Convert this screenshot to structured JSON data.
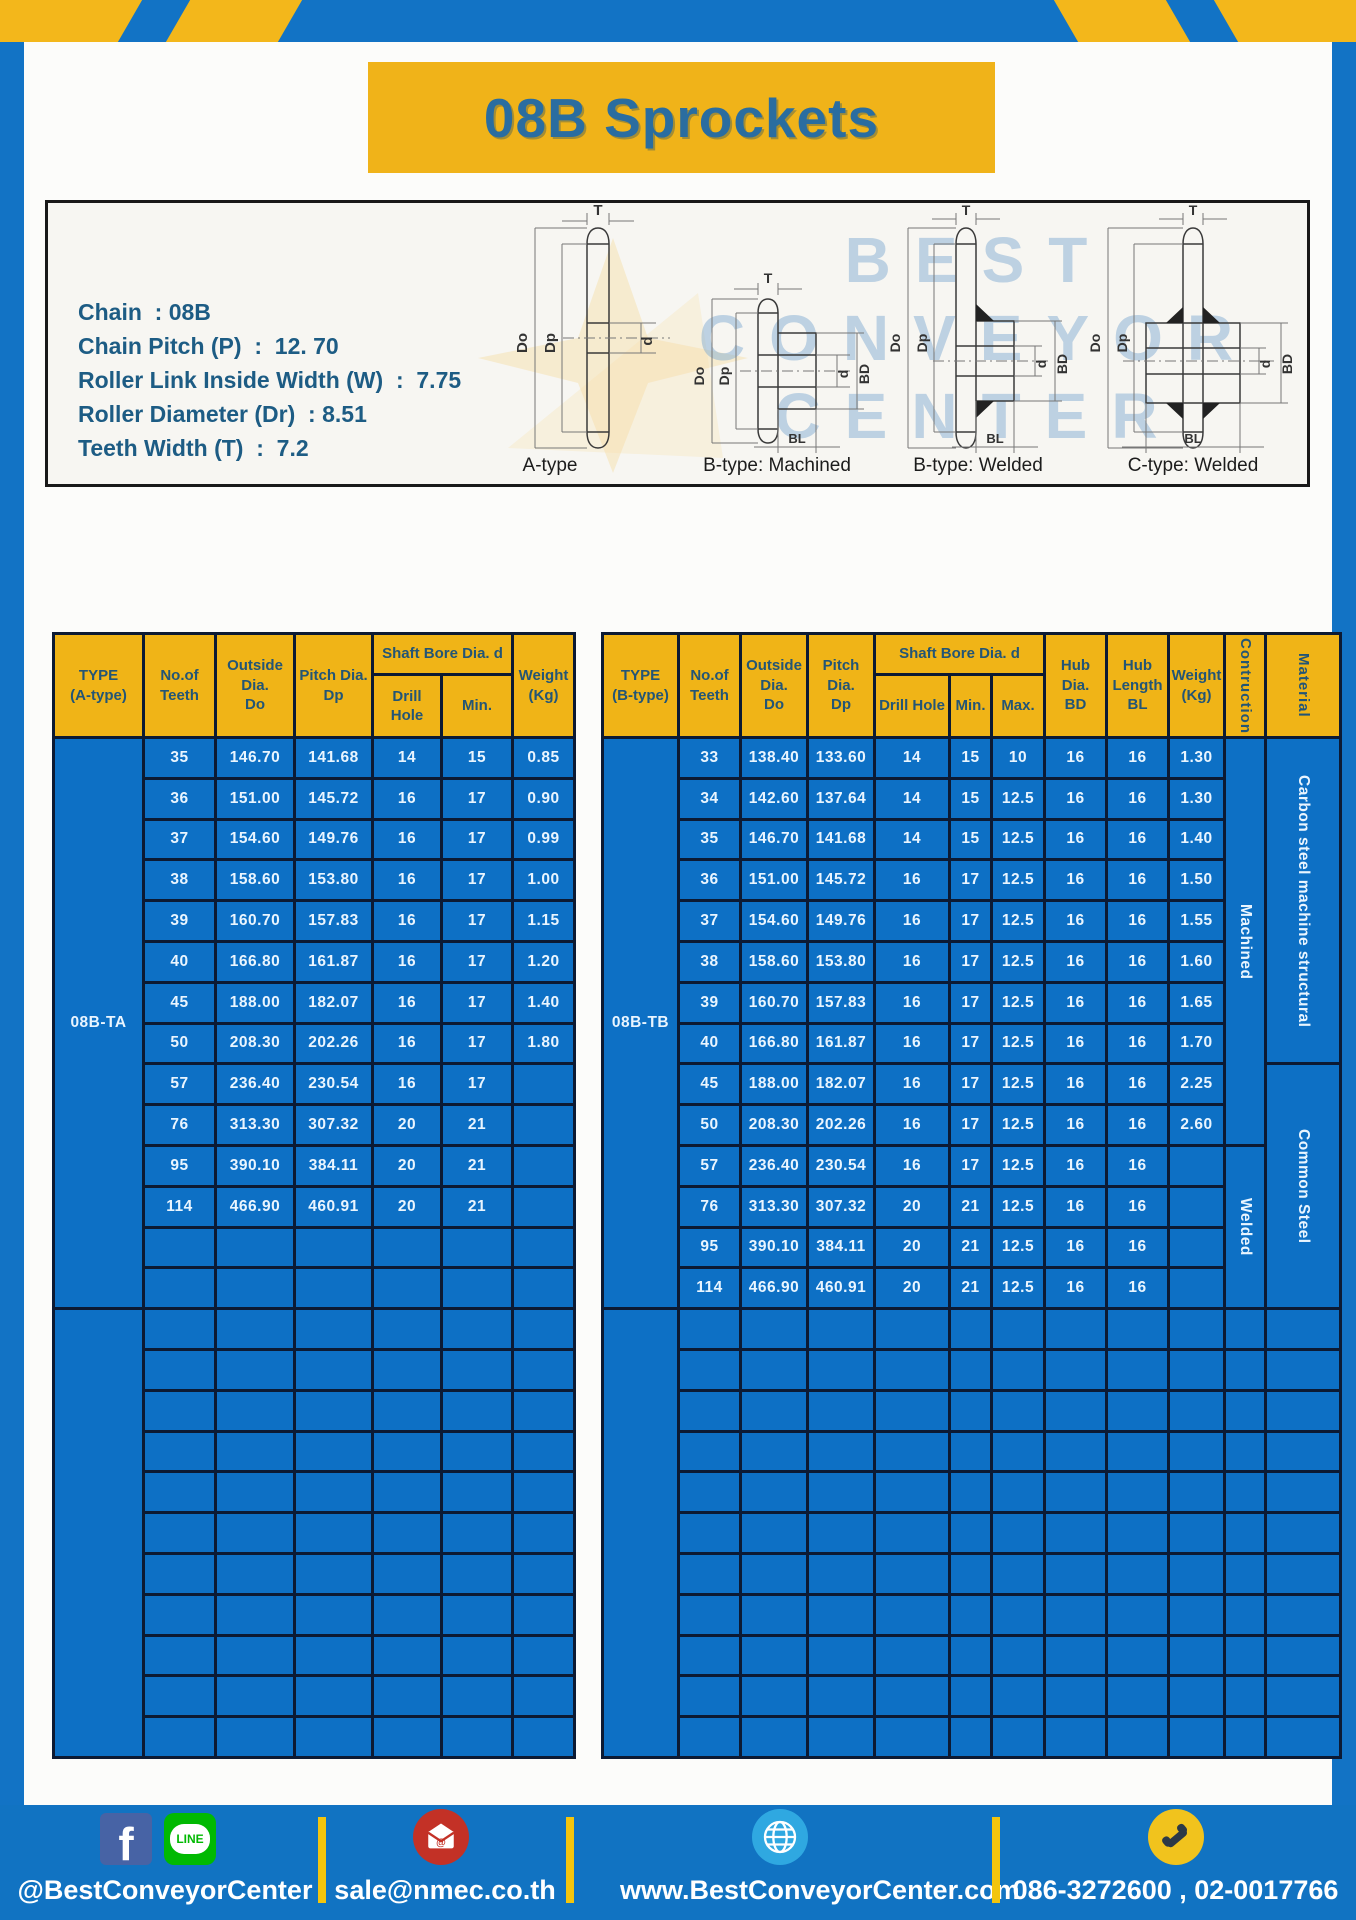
{
  "header": {
    "title": "08B Sprockets"
  },
  "specs": {
    "lines": [
      "Chain  : 08B",
      "Chain Pitch (P)  :  12. 70",
      "Roller Link Inside Width (W)  :  7.75",
      "Roller Diameter (Dr)  : 8.51",
      "Teeth Width (T)  :  7.2"
    ]
  },
  "diagram": {
    "captions": [
      "A-type",
      "B-type: Machined",
      "B-type: Welded",
      "C-type: Welded"
    ],
    "labels": {
      "t": "T",
      "outer": "Do",
      "pitch": "Dp",
      "bore": "d",
      "hub_dia": "BD",
      "hub_len": "BL"
    },
    "watermark": [
      "BEST",
      "CONVEYOR",
      "CENTER"
    ]
  },
  "tables": {
    "left": {
      "header": {
        "type": "TYPE\n(A-type)",
        "teeth": "No.of\nTeeth",
        "outside": "Outside\nDia.\nDo",
        "pitch": "Pitch Dia.\nDp",
        "shaft_bore": "Shaft Bore Dia. d",
        "drill": "Drill Hole",
        "min": "Min.",
        "weight": "Weight\n(Kg)"
      },
      "col_widths": [
        90,
        72,
        79,
        78,
        69,
        71,
        62
      ],
      "data_cols": 6,
      "total_rows": 25,
      "type_groups": [
        {
          "label": "08B-TA",
          "span": 14
        },
        {
          "label": "",
          "span": 11
        }
      ],
      "trailing": [],
      "rows": [
        [
          "35",
          "146.70",
          "141.68",
          "14",
          "15",
          "0.85"
        ],
        [
          "36",
          "151.00",
          "145.72",
          "16",
          "17",
          "0.90"
        ],
        [
          "37",
          "154.60",
          "149.76",
          "16",
          "17",
          "0.99"
        ],
        [
          "38",
          "158.60",
          "153.80",
          "16",
          "17",
          "1.00"
        ],
        [
          "39",
          "160.70",
          "157.83",
          "16",
          "17",
          "1.15"
        ],
        [
          "40",
          "166.80",
          "161.87",
          "16",
          "17",
          "1.20"
        ],
        [
          "45",
          "188.00",
          "182.07",
          "16",
          "17",
          "1.40"
        ],
        [
          "50",
          "208.30",
          "202.26",
          "16",
          "17",
          "1.80"
        ],
        [
          "57",
          "236.40",
          "230.54",
          "16",
          "17",
          ""
        ],
        [
          "76",
          "313.30",
          "307.32",
          "20",
          "21",
          ""
        ],
        [
          "95",
          "390.10",
          "384.11",
          "20",
          "21",
          ""
        ],
        [
          "114",
          "466.90",
          "460.91",
          "20",
          "21",
          ""
        ]
      ]
    },
    "right": {
      "header": {
        "type": "TYPE\n(B-type)",
        "teeth": "No.of\nTeeth",
        "outside": "Outside\nDia.\nDo",
        "pitch": "Pitch Dia.\nDp",
        "shaft_bore": "Shaft Bore Dia. d",
        "drill": "Drill Hole",
        "min": "Min.",
        "max": "Max.",
        "hub_dia": "Hub Dia.\nBD",
        "hub_len": "Hub\nLength\nBL",
        "weight": "Weight\n(Kg)",
        "construction": "Contruction",
        "material": "Material"
      },
      "col_widths": [
        76,
        62,
        67,
        67,
        75,
        42,
        53,
        62,
        62,
        56,
        41,
        36
      ],
      "data_cols": 9,
      "total_rows": 25,
      "type_groups": [
        {
          "label": "08B-TB",
          "span": 14
        },
        {
          "label": "",
          "span": 11
        }
      ],
      "trailing": [
        {
          "name": "construction",
          "vertical": true,
          "groups": [
            {
              "label": "Machined",
              "span": 10
            },
            {
              "label": "Welded",
              "span": 4
            }
          ]
        },
        {
          "name": "material",
          "vertical": true,
          "groups": [
            {
              "label": "Carbon steel  machine structural",
              "span": 8
            },
            {
              "label": "Common Steel",
              "span": 6
            }
          ]
        }
      ],
      "rows": [
        [
          "33",
          "138.40",
          "133.60",
          "14",
          "15",
          "10",
          "16",
          "16",
          "1.30"
        ],
        [
          "34",
          "142.60",
          "137.64",
          "14",
          "15",
          "12.5",
          "16",
          "16",
          "1.30"
        ],
        [
          "35",
          "146.70",
          "141.68",
          "14",
          "15",
          "12.5",
          "16",
          "16",
          "1.40"
        ],
        [
          "36",
          "151.00",
          "145.72",
          "16",
          "17",
          "12.5",
          "16",
          "16",
          "1.50"
        ],
        [
          "37",
          "154.60",
          "149.76",
          "16",
          "17",
          "12.5",
          "16",
          "16",
          "1.55"
        ],
        [
          "38",
          "158.60",
          "153.80",
          "16",
          "17",
          "12.5",
          "16",
          "16",
          "1.60"
        ],
        [
          "39",
          "160.70",
          "157.83",
          "16",
          "17",
          "12.5",
          "16",
          "16",
          "1.65"
        ],
        [
          "40",
          "166.80",
          "161.87",
          "16",
          "17",
          "12.5",
          "16",
          "16",
          "1.70"
        ],
        [
          "45",
          "188.00",
          "182.07",
          "16",
          "17",
          "12.5",
          "16",
          "16",
          "2.25"
        ],
        [
          "50",
          "208.30",
          "202.26",
          "16",
          "17",
          "12.5",
          "16",
          "16",
          "2.60"
        ],
        [
          "57",
          "236.40",
          "230.54",
          "16",
          "17",
          "12.5",
          "16",
          "16",
          ""
        ],
        [
          "76",
          "313.30",
          "307.32",
          "20",
          "21",
          "12.5",
          "16",
          "16",
          ""
        ],
        [
          "95",
          "390.10",
          "384.11",
          "20",
          "21",
          "12.5",
          "16",
          "16",
          ""
        ],
        [
          "114",
          "466.90",
          "460.91",
          "20",
          "21",
          "12.5",
          "16",
          "16",
          ""
        ]
      ]
    }
  },
  "footer": {
    "fb_label": "f",
    "line_label": "LINE",
    "social_handle": "@BestConveyorCenter",
    "email": "sale@nmec.co.th",
    "website": "www.BestConveyorCenter.com",
    "phones": "086-3272600 , 02-0017766"
  }
}
